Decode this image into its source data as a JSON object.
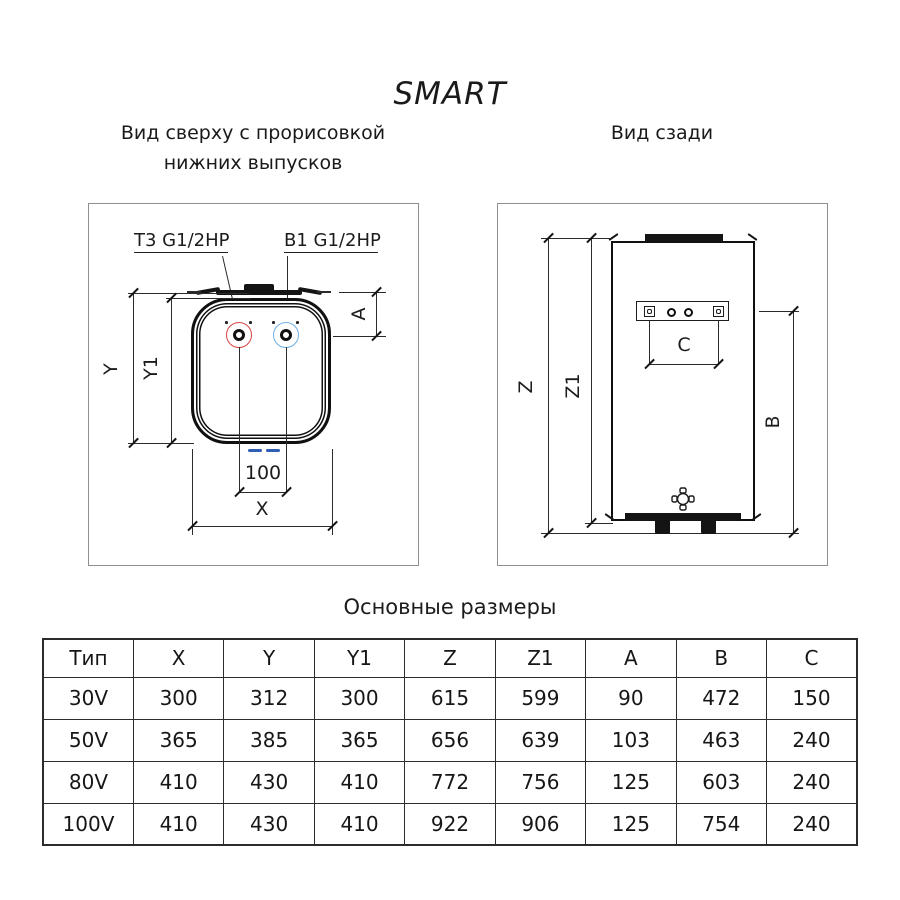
{
  "title": "SMART",
  "top_view": {
    "caption_line1": "Вид сверху с прорисовкой",
    "caption_line2": "нижних выпусков",
    "port_hot_label": "T3 G1/2HP",
    "port_cold_label": "B1 G1/2HP",
    "dims": {
      "y": "Y",
      "y1": "Y1",
      "a": "A",
      "port_spacing": "100",
      "x": "X"
    }
  },
  "back_view": {
    "caption": "Вид сзади",
    "dims": {
      "z": "Z",
      "z1": "Z1",
      "b": "B",
      "c": "C"
    }
  },
  "table": {
    "title": "Основные размеры",
    "headers": [
      "Тип",
      "X",
      "Y",
      "Y1",
      "Z",
      "Z1",
      "A",
      "B",
      "C"
    ],
    "rows": [
      [
        "30V",
        "300",
        "312",
        "300",
        "615",
        "599",
        "90",
        "472",
        "150"
      ],
      [
        "50V",
        "365",
        "385",
        "365",
        "656",
        "639",
        "103",
        "463",
        "240"
      ],
      [
        "80V",
        "410",
        "430",
        "410",
        "772",
        "756",
        "125",
        "603",
        "240"
      ],
      [
        "100V",
        "410",
        "430",
        "410",
        "922",
        "906",
        "125",
        "754",
        "240"
      ]
    ]
  },
  "colors": {
    "hot_port": "#d94343",
    "cold_port": "#6fb0e8",
    "bottom_fitting": "#2f5fb5",
    "drawing_line": "#2b2b2b"
  }
}
